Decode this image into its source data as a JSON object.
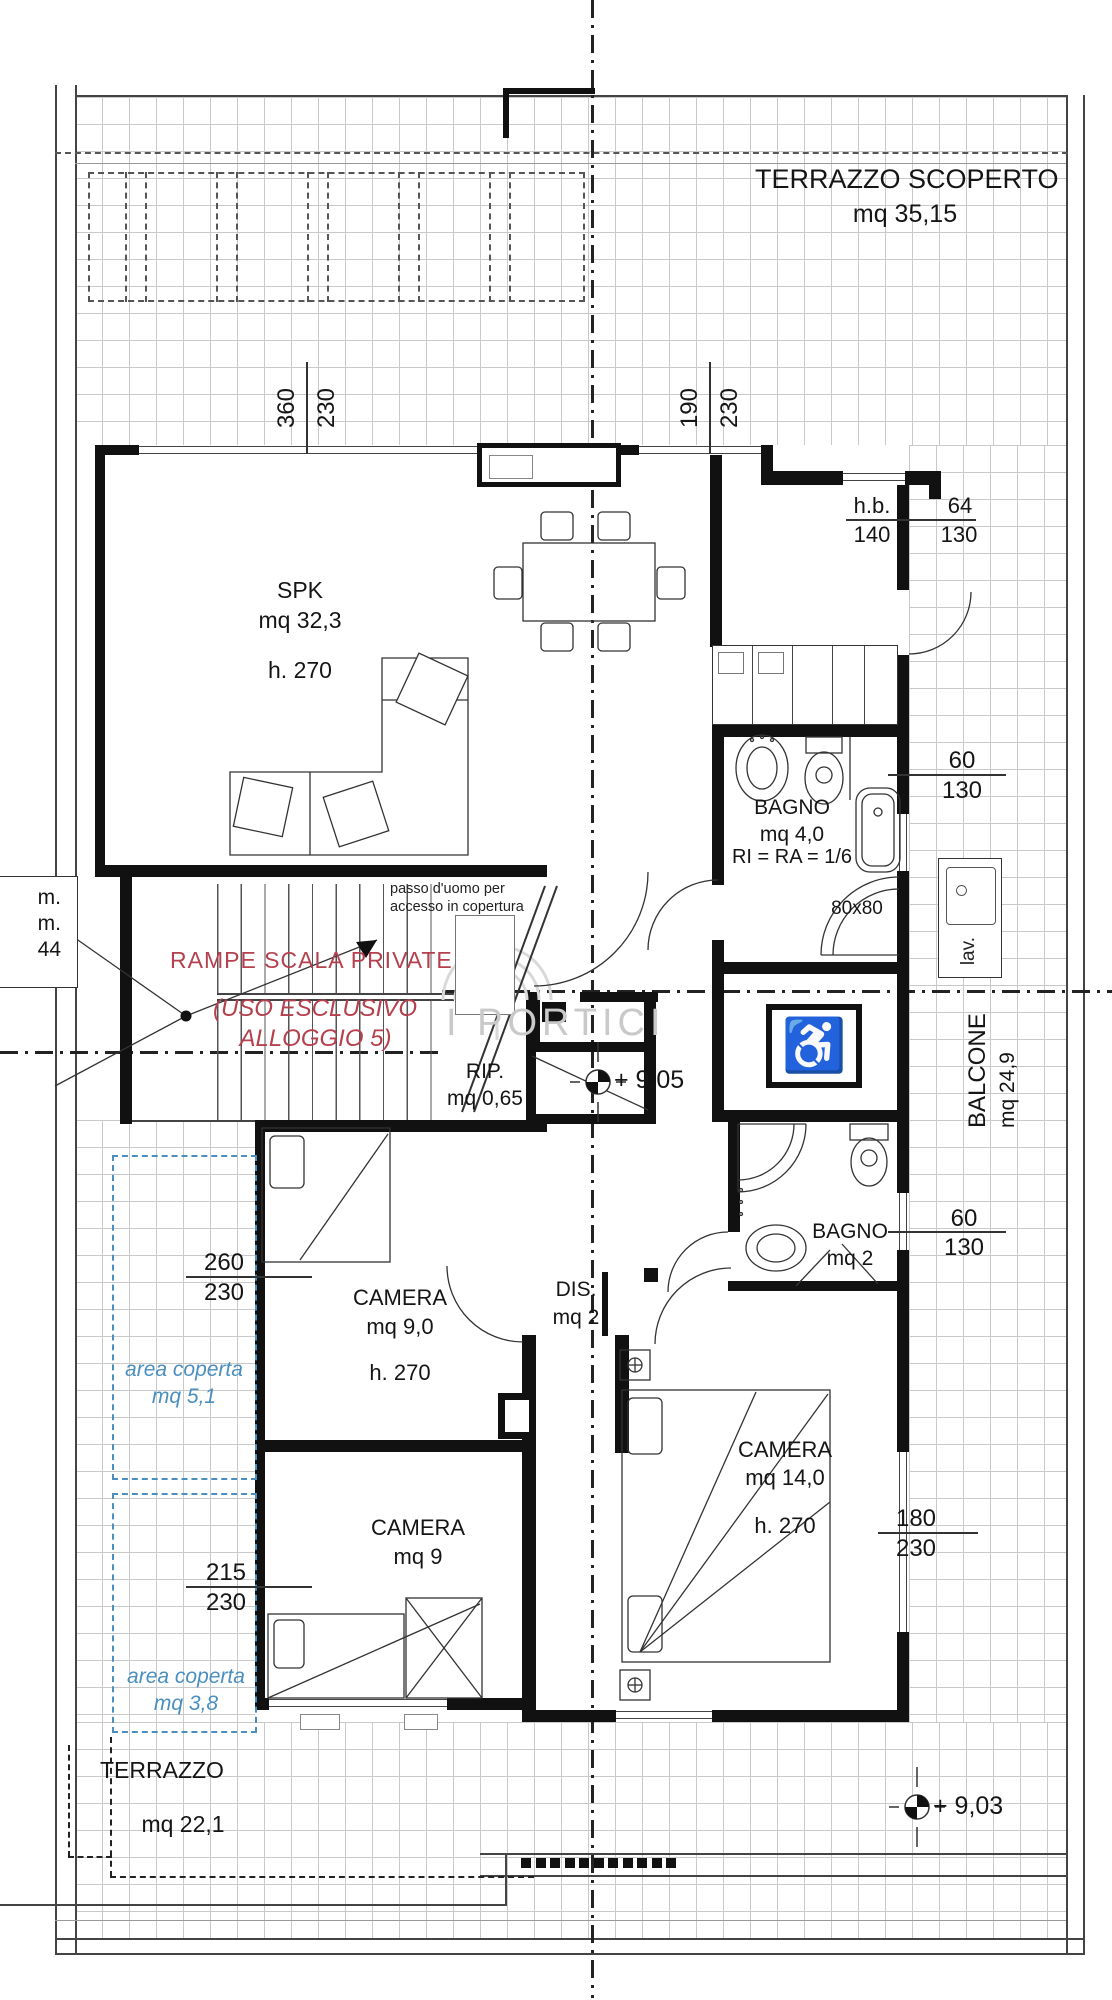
{
  "labels": {
    "terrazzo_scoperto": {
      "name": "TERRAZZO SCOPERTO",
      "area": "mq 35,15"
    },
    "spk": {
      "name": "SPK",
      "area": "mq 32,3",
      "height": "h. 270"
    },
    "bagno4": {
      "name": "BAGNO",
      "area": "mq 4,0",
      "note": "RI = RA = 1/6"
    },
    "shower_size": "80x80",
    "lav": "lav.",
    "balcone": {
      "name": "BALCONE",
      "area": "mq 24,9"
    },
    "stairs": {
      "line1": "RAMPE SCALA PRIVATE",
      "line2": "(USO ESCLUSIVO",
      "line3": "ALLOGGIO 5)"
    },
    "passo": {
      "line1": "passo d'uomo per",
      "line2": "accesso in copertura"
    },
    "rip": {
      "name": "RIP.",
      "area": "mq 0,65"
    },
    "dis": {
      "name": "DIS.",
      "area": "mq 2"
    },
    "camera1": {
      "name": "CAMERA",
      "area": "mq 9,0",
      "height": "h. 270"
    },
    "bagno2": {
      "name": "BAGNO",
      "area": "mq 2"
    },
    "camera14": {
      "name": "CAMERA",
      "area": "mq 14,0",
      "height": "h. 270"
    },
    "camera2": {
      "name": "CAMERA",
      "area": "mq 9"
    },
    "terrazzo": {
      "name": "TERRAZZO",
      "area": "mq 22,1"
    },
    "area_coperta1": {
      "line1": "area coperta",
      "line2": "mq 5,1"
    },
    "area_coperta2": {
      "line1": "area coperta",
      "line2": "mq 3,8"
    },
    "elevation_center": "+ 9,05",
    "elevation_terrace": "+ 9,03",
    "cut_label": {
      "line1": "m.",
      "line2": "m.",
      "line3": "44"
    },
    "watermark": "I PORTICI",
    "accessible_icon_glyph": "♿"
  },
  "dimensions": {
    "win_top_left": {
      "w": "360",
      "h": "230"
    },
    "win_top_right": {
      "w": "190",
      "h": "230"
    },
    "win_hb": {
      "label": "h.b.",
      "sill": "140",
      "w": "64",
      "h": "130"
    },
    "win_bagno4": {
      "w": "60",
      "h": "130"
    },
    "win_bagno2": {
      "w": "60",
      "h": "130"
    },
    "win_camera14": {
      "w": "180",
      "h": "230"
    },
    "win_camera1_left": {
      "w": "260",
      "h": "230"
    },
    "win_camera2_left": {
      "w": "215",
      "h": "230"
    }
  },
  "colors": {
    "stair_note_red": "#b5414e",
    "area_coperta_blue": "#4a8fc0",
    "tile_grid": "#c9c9c9",
    "watermark_gray": "#c9c9c9",
    "linework": "#333333"
  }
}
